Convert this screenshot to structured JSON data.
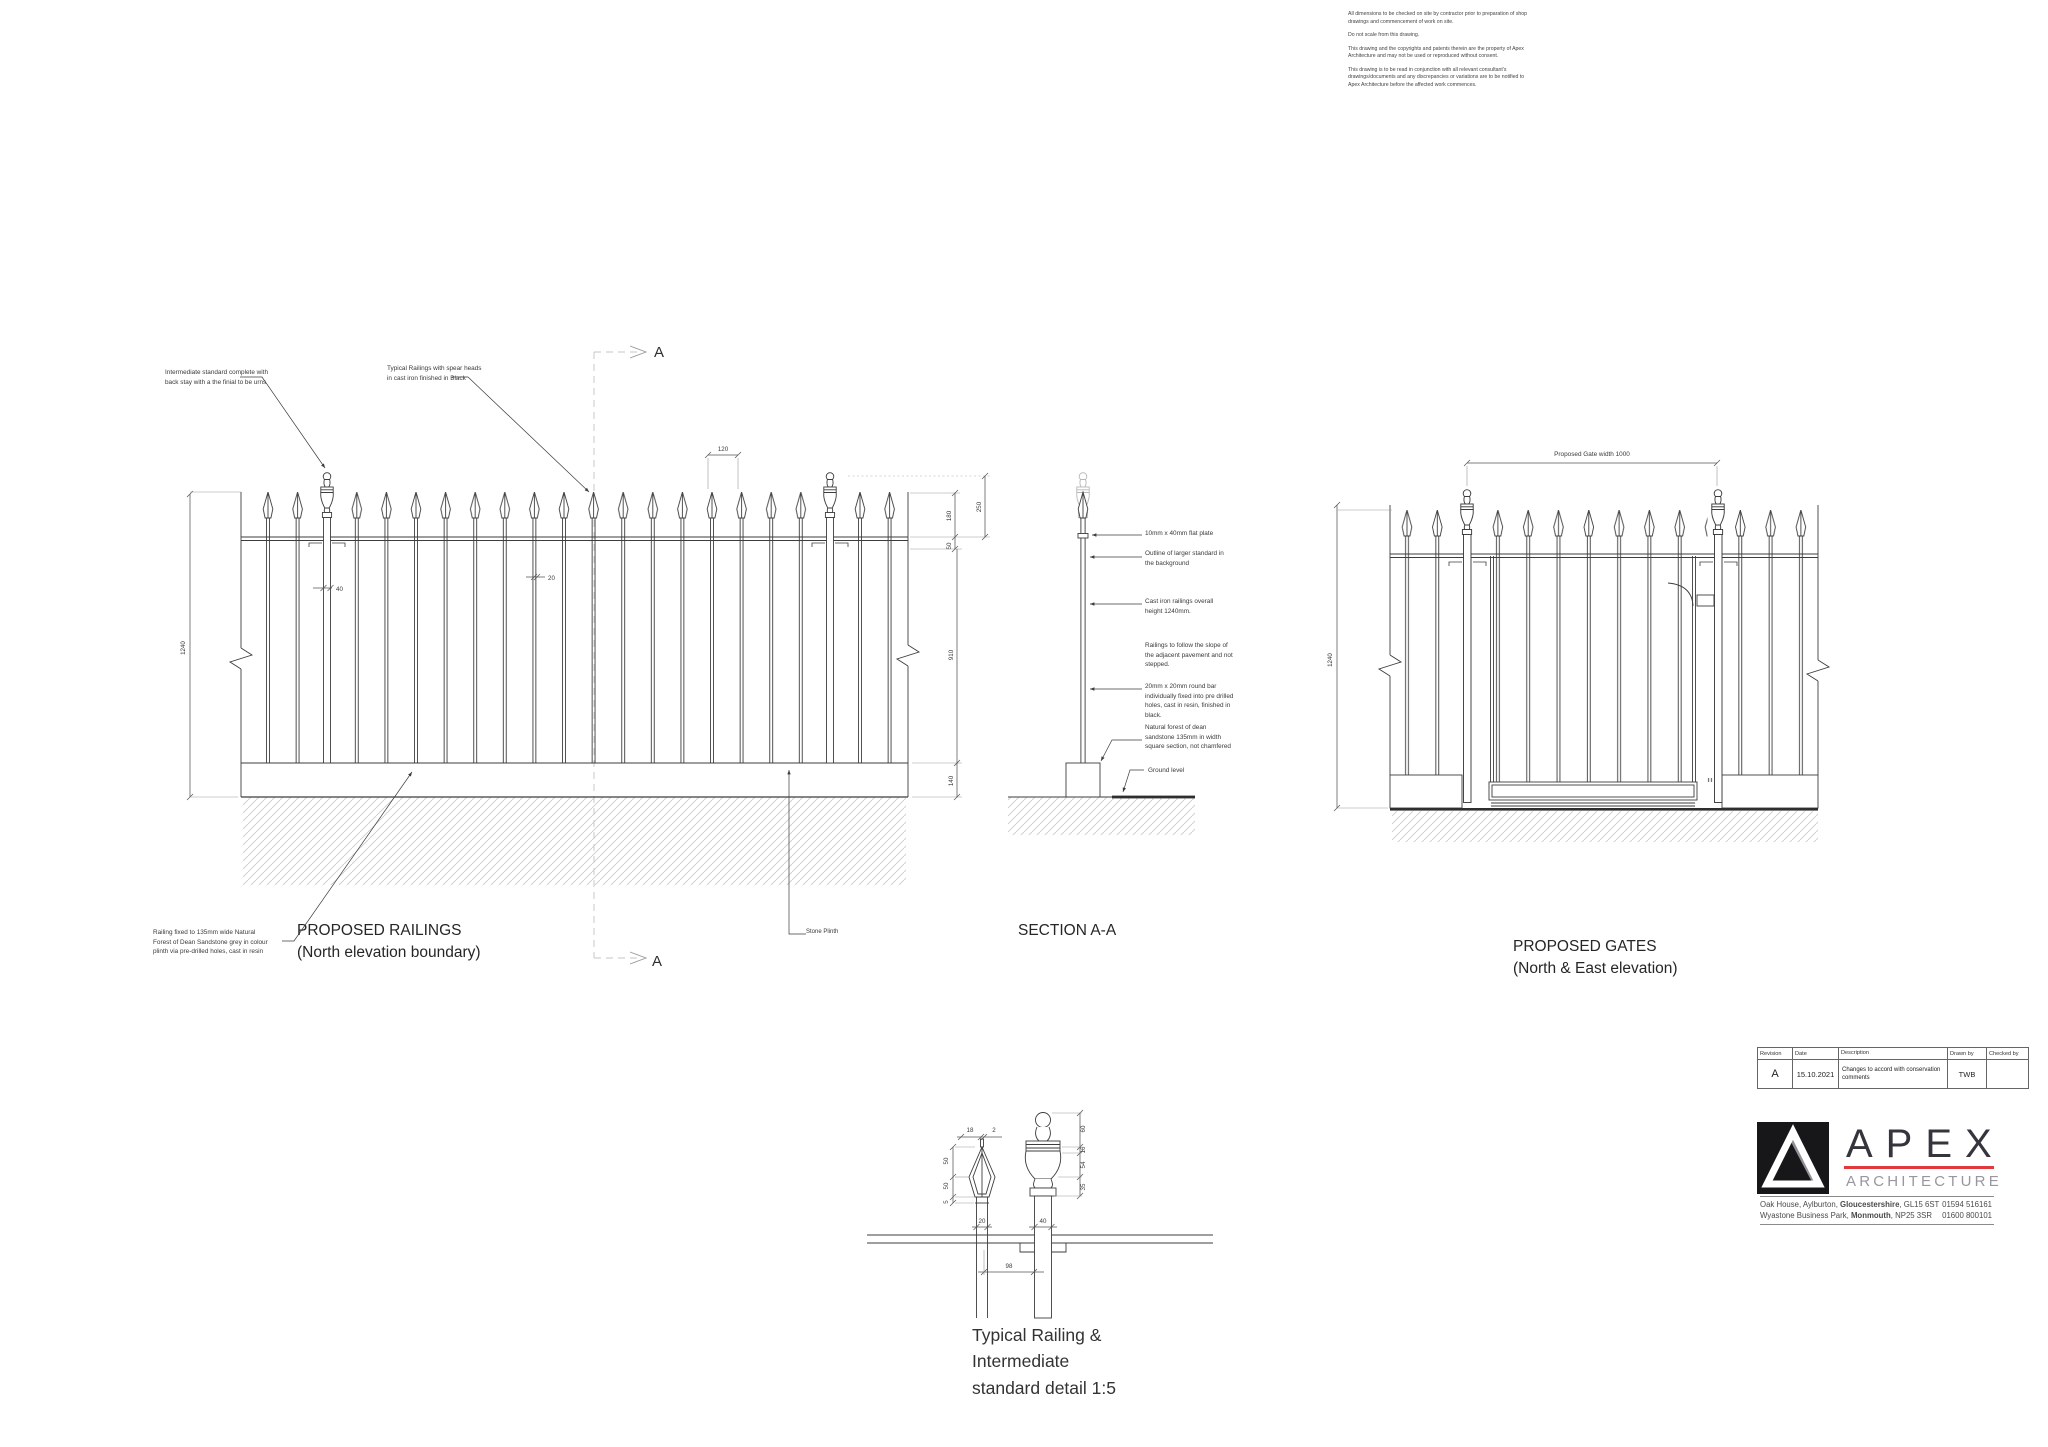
{
  "notes": {
    "p1": "All dimensions to be checked on site by contractor prior to preparation of shop drawings and commencement of work on site.",
    "p2": "Do not scale from this drawing.",
    "p3": "This drawing and the copyrights and patents therein are the property of Apex Architecture and may not be used or reproduced without consent.",
    "p4": "This drawing is to be read in conjunction with all relevant consultant's drawings/documents and any discrepancies or variations are to be notified to Apex Architecture before the affected work commences."
  },
  "railings": {
    "title1": "PROPOSED RAILINGS",
    "title2": "(North elevation boundary)",
    "note_intermediate": "Intermediate standard complete with back stay with a the finial to be urns",
    "note_typical": "Typical Railings with spear heads in cast iron finished in Black",
    "note_fixing": "Railing fixed to 135mm wide Natural Forest of Dean Sandstone grey in colour plinth via pre-drilled holes, cast in resin",
    "note_stone_plinth": "Stone Plinth",
    "dim_height": "1240",
    "dim_spacing": "120",
    "dim_standard": "40",
    "dim_bar": "20",
    "dim_spear": "180",
    "dim_finial": "250",
    "dim_rail": "50",
    "dim_below": "910",
    "dim_plinth": "140"
  },
  "section": {
    "title": "SECTION A-A",
    "marker": "A",
    "ann_plate": "10mm x 40mm flat plate",
    "ann_outline": "Outline of larger standard in the background",
    "ann_height": "Cast iron railings overall height 1240mm.",
    "ann_slope": "Railings to follow the slope of the adjacent pavement and not stepped.",
    "ann_bar": "20mm x 20mm round bar individually fixed into pre drilled holes, cast in resin, finished in black.",
    "ann_sandstone": "Natural forest of dean sandstone 135mm in width square section, not chamfered",
    "ann_ground": "Ground level"
  },
  "gates": {
    "title1": "PROPOSED GATES",
    "title2": "(North & East elevation)",
    "dim_width": "Proposed Gate width 1000",
    "dim_height": "1240"
  },
  "detail": {
    "title_l1": "Typical Railing &",
    "title_l2": "Intermediate",
    "title_l3": "standard detail 1:5",
    "d18": "18",
    "d2": "2",
    "d50a": "50",
    "d50b": "50",
    "d5": "5",
    "d20": "20",
    "d40": "40",
    "d98": "98",
    "d60": "60",
    "d16": "16",
    "d54": "54",
    "d35": "35"
  },
  "revision_table": {
    "h_revision": "Revision",
    "h_date": "Date",
    "h_description": "Description",
    "h_drawn": "Drawn by",
    "h_checked": "Checked by",
    "r_revision": "A",
    "r_date": "15.10.2021",
    "r_description": "Changes to accord with conservation comments",
    "r_drawn": "TWB",
    "r_checked": ""
  },
  "brand": {
    "name": "APEX",
    "tagline": "ARCHITECTURE",
    "addr1_pre": "Oak House, Aylburton, ",
    "addr1_bold": "Gloucestershire",
    "addr1_post": ", GL15 6ST",
    "phone1": "01594 516161",
    "addr2_pre": "Wyastone Business Park, ",
    "addr2_bold": "Monmouth",
    "addr2_post": ", NP25 3SR",
    "phone2": "01600 800101"
  },
  "colors": {
    "line": "#3d3d3d",
    "accent_red": "#e0393e",
    "brand_dark": "#35353d",
    "brand_grey": "#97979f"
  }
}
